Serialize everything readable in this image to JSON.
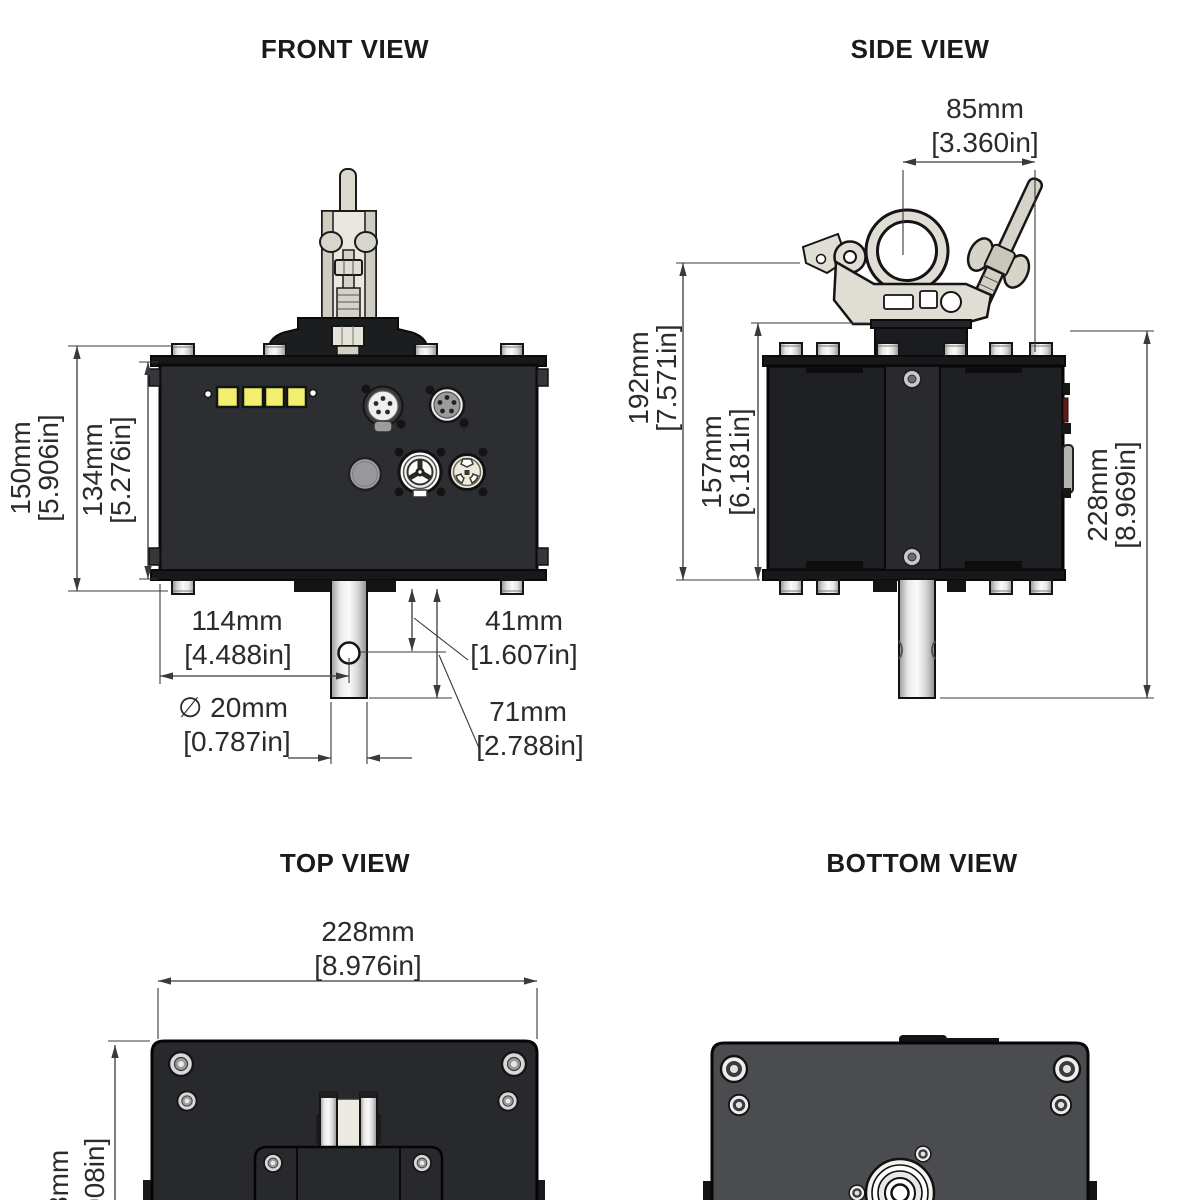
{
  "drawing": {
    "front": {
      "title": "FRONT VIEW",
      "d150_mm": "150mm",
      "d150_in": "[5.906in]",
      "d134_mm": "134mm",
      "d134_in": "[5.276in]",
      "d114_mm": "114mm",
      "d114_in": "[4.488in]",
      "d20_mm": "∅ 20mm",
      "d20_in": "[0.787in]",
      "d41_mm": "41mm",
      "d41_in": "[1.607in]",
      "d71_mm": "71mm",
      "d71_in": "[2.788in]"
    },
    "side": {
      "title": "SIDE VIEW",
      "d85_mm": "85mm",
      "d85_in": "[3.360in]",
      "d192_mm": "192mm",
      "d192_in": "[7.571in]",
      "d157_mm": "157mm",
      "d157_in": "[6.181in]",
      "d228_mm": "228mm",
      "d228_in": "[8.969in]"
    },
    "top": {
      "title": "TOP VIEW",
      "d228_mm": "228mm",
      "d228_in": "[8.976in]",
      "partial_mm": "8mm",
      "partial_in": "008in]"
    },
    "bottom": {
      "title": "BOTTOM VIEW"
    },
    "colors": {
      "led_yellow": "#f2ef6f",
      "enclosure_black": "#2d2e31",
      "side_body_black": "#1f2023",
      "bottom_plate_gray": "#4b4c4f",
      "metal_light": "#e0ddd4",
      "dimension_line": "#3a3a3a"
    }
  }
}
